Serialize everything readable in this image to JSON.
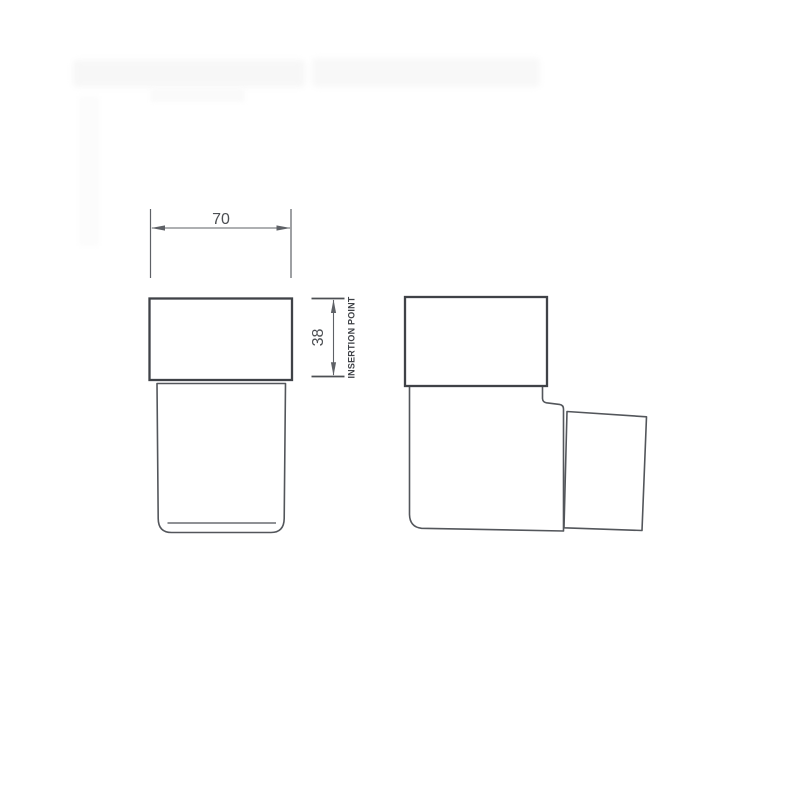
{
  "drawing": {
    "type": "technical-drawing",
    "subject": "wall-mounted tumbler holder, front and side orthographic views",
    "dimensions": {
      "width_label": "70",
      "height_label": "38",
      "insertion_label": "INSERTION POINT"
    }
  },
  "colors": {
    "background": "#ffffff",
    "outline_dark": "#3f4247",
    "outline_mid": "#53565b",
    "dimension_line": "#5e6166",
    "label_text": "#4c4f53"
  }
}
